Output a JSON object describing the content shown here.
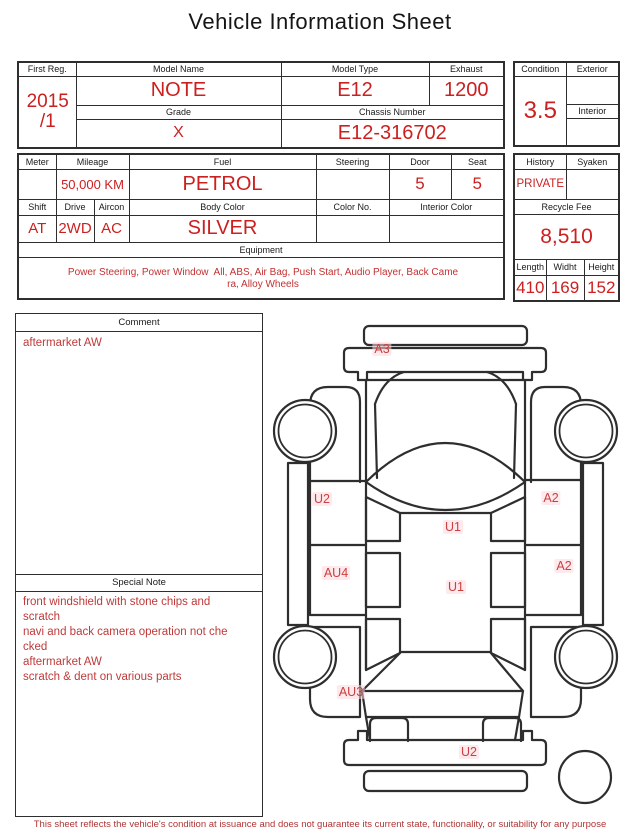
{
  "title": "Vehicle Information Sheet",
  "top_table": {
    "first_reg": {
      "label": "First Reg.",
      "value_line1": "2015",
      "value_line2": "/1"
    },
    "model_name": {
      "label": "Model Name",
      "value": "NOTE"
    },
    "model_type": {
      "label": "Model Type",
      "value": "E12"
    },
    "exhaust": {
      "label": "Exhaust",
      "value": "1200"
    },
    "grade": {
      "label": "Grade",
      "value": "X"
    },
    "chassis_number": {
      "label": "Chassis Number",
      "value": "E12-316702"
    }
  },
  "condition_panel": {
    "condition": {
      "label": "Condition",
      "value": "3.5"
    },
    "exterior": {
      "label": "Exterior",
      "value": ""
    },
    "interior": {
      "label": "Interior",
      "value": ""
    }
  },
  "spec_table": {
    "meter": {
      "label": "Meter",
      "value": ""
    },
    "mileage": {
      "label": "Mileage",
      "value": "50,000 KM"
    },
    "fuel": {
      "label": "Fuel",
      "value": "PETROL"
    },
    "steering": {
      "label": "Steering",
      "value": ""
    },
    "door": {
      "label": "Door",
      "value": "5"
    },
    "seat": {
      "label": "Seat",
      "value": "5"
    },
    "shift": {
      "label": "Shift",
      "value": "AT"
    },
    "drive": {
      "label": "Drive",
      "value": "2WD"
    },
    "aircon": {
      "label": "Aircon",
      "value": "AC"
    },
    "body_color": {
      "label": "Body Color",
      "value": "SILVER"
    },
    "color_no": {
      "label": "Color No.",
      "value": ""
    },
    "interior_color": {
      "label": "Interior Color",
      "value": ""
    },
    "equipment": {
      "label": "Equipment",
      "line1": "Power Steering, Power Window  All, ABS, Air Bag, Push Start, Audio Player, Back Came",
      "line2": "ra, Alloy Wheels"
    }
  },
  "history_panel": {
    "history": {
      "label": "History",
      "value": "PRIVATE"
    },
    "syaken": {
      "label": "Syaken",
      "value": ""
    },
    "recycle_fee": {
      "label": "Recycle Fee",
      "value": "8,510"
    },
    "length": {
      "label": "Length",
      "value": "410"
    },
    "width": {
      "label": "Widht",
      "value": "169"
    },
    "height": {
      "label": "Height",
      "value": "152"
    }
  },
  "comment_box": {
    "header": "Comment",
    "text": "aftermarket AW"
  },
  "special_note_box": {
    "header": "Special Note",
    "lines": [
      "front windshield with stone chips and",
      "scratch",
      "navi and back camera operation not che",
      "cked",
      "aftermarket AW",
      "scratch & dent on various parts"
    ]
  },
  "diagram": {
    "labels": [
      {
        "text": "A3"
      },
      {
        "text": "U2"
      },
      {
        "text": "A2"
      },
      {
        "text": "U1"
      },
      {
        "text": "AU4"
      },
      {
        "text": "A2"
      },
      {
        "text": "U1"
      },
      {
        "text": "AU3"
      },
      {
        "text": "U2"
      }
    ]
  },
  "footer": "This sheet reflects the vehicle's condition at issuance and does not guarantee its current state, functionality, or suitability for any purpose",
  "colors": {
    "accent_red": "#cc1f1f",
    "note_red": "#bf3a3a",
    "border": "#2e2e2e"
  }
}
